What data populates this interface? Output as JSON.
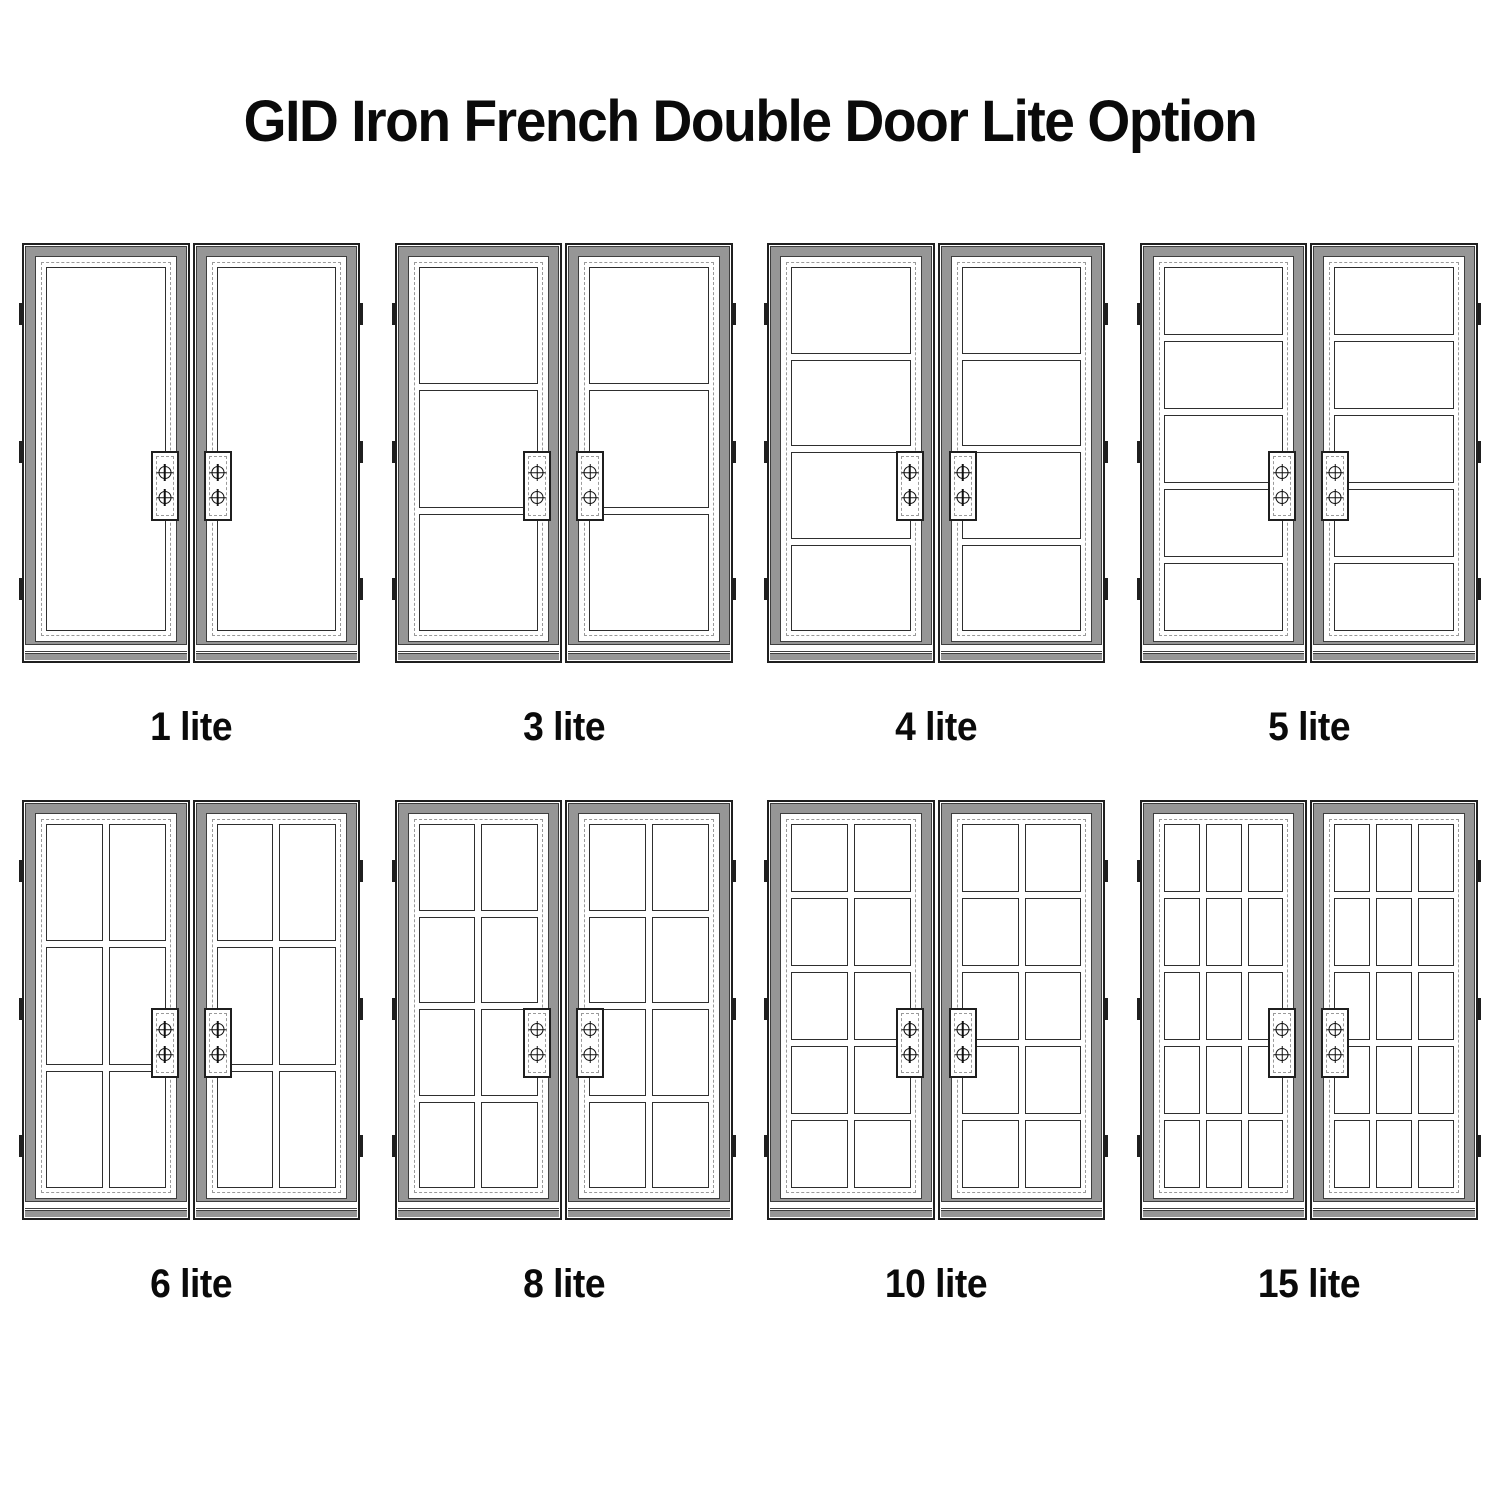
{
  "title": "GID Iron French Double Door Lite Option",
  "doors": [
    {
      "label": "1 lite",
      "lites": 1,
      "cols": 1,
      "rows": 1
    },
    {
      "label": "3 lite",
      "lites": 3,
      "cols": 1,
      "rows": 3
    },
    {
      "label": "4 lite",
      "lites": 4,
      "cols": 1,
      "rows": 4
    },
    {
      "label": "5 lite",
      "lites": 5,
      "cols": 1,
      "rows": 5
    },
    {
      "label": "6 lite",
      "lites": 6,
      "cols": 2,
      "rows": 3
    },
    {
      "label": "8 lite",
      "lites": 8,
      "cols": 2,
      "rows": 4
    },
    {
      "label": "10 lite",
      "lites": 10,
      "cols": 2,
      "rows": 5
    },
    {
      "label": "15 lite",
      "lites": 15,
      "cols": 3,
      "rows": 5
    }
  ],
  "hardware": {
    "screws_per_plate": 2,
    "hinges_per_leaf": 3,
    "leaves_per_door": 2
  },
  "colors": {
    "line": "#1f1f1f",
    "steel_gray": "#969696",
    "dash": "#9a9a9a",
    "background": "#ffffff",
    "text": "#0a0a0a"
  }
}
